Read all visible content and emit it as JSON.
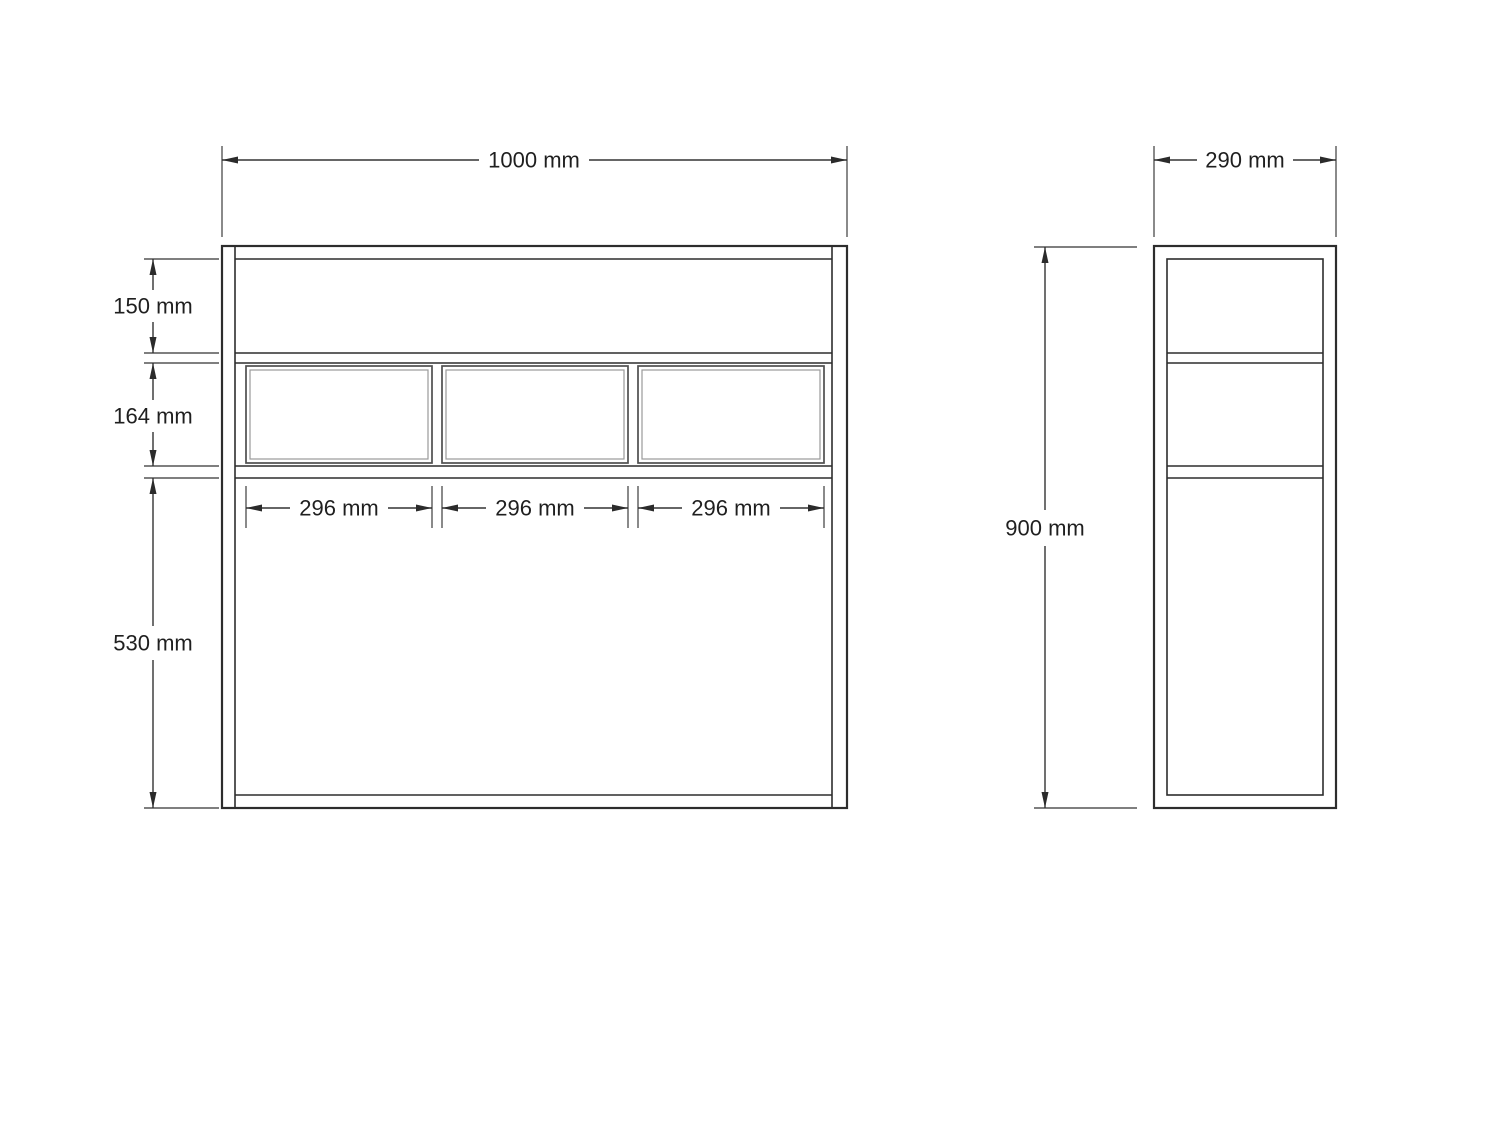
{
  "front_view": {
    "overall_width": {
      "label": "1000 mm"
    },
    "left_sections": [
      {
        "label": "150 mm"
      },
      {
        "label": "164 mm"
      },
      {
        "label": "530 mm"
      }
    ],
    "drawer_widths": [
      {
        "label": "296 mm"
      },
      {
        "label": "296 mm"
      },
      {
        "label": "296 mm"
      }
    ]
  },
  "side_view": {
    "overall_width": {
      "label": "290 mm"
    },
    "overall_height": {
      "label": "900 mm"
    }
  }
}
